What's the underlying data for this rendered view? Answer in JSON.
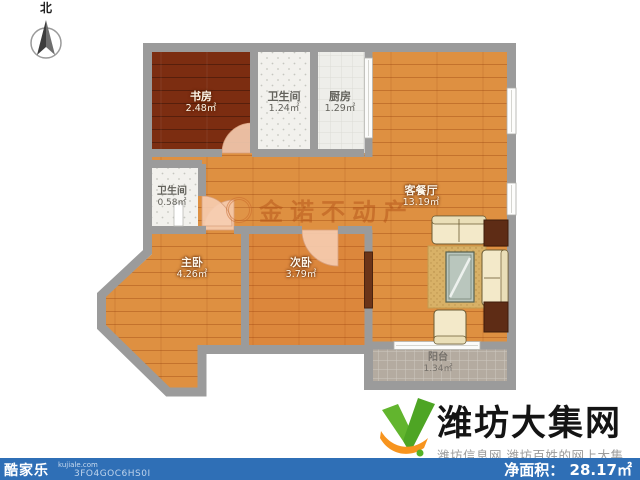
{
  "compass": {
    "north_label": "北"
  },
  "floorplan": {
    "watermark": {
      "brand": "金诺不动产"
    },
    "rooms": [
      {
        "key": "study",
        "name": "书房",
        "area": "2.48㎡"
      },
      {
        "key": "bathroom-top",
        "name": "卫生间",
        "area": "1.24㎡"
      },
      {
        "key": "kitchen",
        "name": "厨房",
        "area": "1.29㎡"
      },
      {
        "key": "living-dining",
        "name": "客餐厅",
        "area": "13.19㎡"
      },
      {
        "key": "bathroom-small",
        "name": "卫生间",
        "area": "0.58㎡"
      },
      {
        "key": "master-bedroom",
        "name": "主卧",
        "area": "4.26㎡"
      },
      {
        "key": "second-bedroom",
        "name": "次卧",
        "area": "3.79㎡"
      },
      {
        "key": "balcony",
        "name": "阳台",
        "area": "1.34㎡"
      }
    ]
  },
  "branding": {
    "site_name": "潍坊大集网",
    "tagline": "潍坊信息网 潍坊百姓的网上大集"
  },
  "footer": {
    "app_name": "酷家乐",
    "app_url": "kujiale.com",
    "plan_id": "3FO4GOC6HS0I",
    "net_area_label": "净面积：",
    "net_area_value": "28.17㎡"
  },
  "colors": {
    "wall": "#9b9b9b",
    "wood_light": "#de9041",
    "wood_dark": "#7c2d11",
    "tile_white": "#f2f1ed",
    "balcony_tile": "#b4aba0",
    "bar_blue": "#2f6fb6",
    "logo_green": "#54b226",
    "logo_orange": "#f7941e"
  }
}
